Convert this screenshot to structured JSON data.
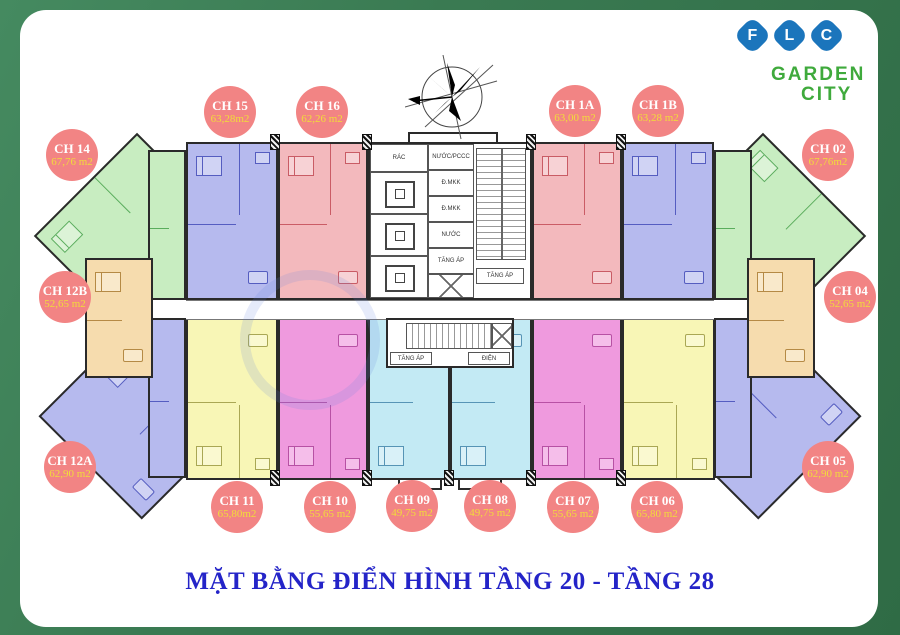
{
  "brand": {
    "letters": [
      "F",
      "L",
      "C"
    ],
    "line1": "GARDEN",
    "line2": "CITY",
    "tile_color": "#1b75bc",
    "text_color": "#3faa3c"
  },
  "title": "MẶT BẰNG ĐIỂN HÌNH TẦNG 20 - TẦNG 28",
  "title_color": "#2424c8",
  "badge_color": "#f28484",
  "badge_area_text_color": "#f1dc3a",
  "background_color": "#3a7a52",
  "units": [
    {
      "id": "CH 14",
      "area": "67,76 m2",
      "fill": "#c8edc1"
    },
    {
      "id": "CH 15",
      "area": "63,28m2",
      "fill": "#b6baee"
    },
    {
      "id": "CH 16",
      "area": "62,26 m2",
      "fill": "#f3b9bd"
    },
    {
      "id": "CH 1A",
      "area": "63,00 m2",
      "fill": "#f3b9bd"
    },
    {
      "id": "CH 1B",
      "area": "63,28 m2",
      "fill": "#b6baee"
    },
    {
      "id": "CH 02",
      "area": "67,76m2",
      "fill": "#c8edc1"
    },
    {
      "id": "CH 12B",
      "area": "52,65 m2",
      "fill": "#f6dcae"
    },
    {
      "id": "CH 04",
      "area": "52,65 m2",
      "fill": "#f6dcae"
    },
    {
      "id": "CH 12A",
      "area": "62,90 m2",
      "fill": "#b6baee"
    },
    {
      "id": "CH 05",
      "area": "62,90 m2",
      "fill": "#b6baee"
    },
    {
      "id": "CH 11",
      "area": "65,80m2",
      "fill": "#f8f6b6"
    },
    {
      "id": "CH 10",
      "area": "55,65 m2",
      "fill": "#ef9ade"
    },
    {
      "id": "CH 09",
      "area": "49,75 m2",
      "fill": "#c3eaf4"
    },
    {
      "id": "CH 08",
      "area": "49,75 m2",
      "fill": "#c3eaf4"
    },
    {
      "id": "CH 07",
      "area": "55,65 m2",
      "fill": "#ef9ade"
    },
    {
      "id": "CH 06",
      "area": "65,80 m2",
      "fill": "#f8f6b6"
    }
  ],
  "core": {
    "rac": "RÁC",
    "shaft1": "NƯỚC/PCCC",
    "shaft2": "Đ.MKK",
    "shaft3": "Đ.MKK",
    "shaft4": "NƯỚC",
    "shaft5": "TĂNG ÁP",
    "stair_label": "TĂNG ÁP",
    "pressure_label": "TĂNG ÁP",
    "electric_label": "ĐIỆN"
  }
}
